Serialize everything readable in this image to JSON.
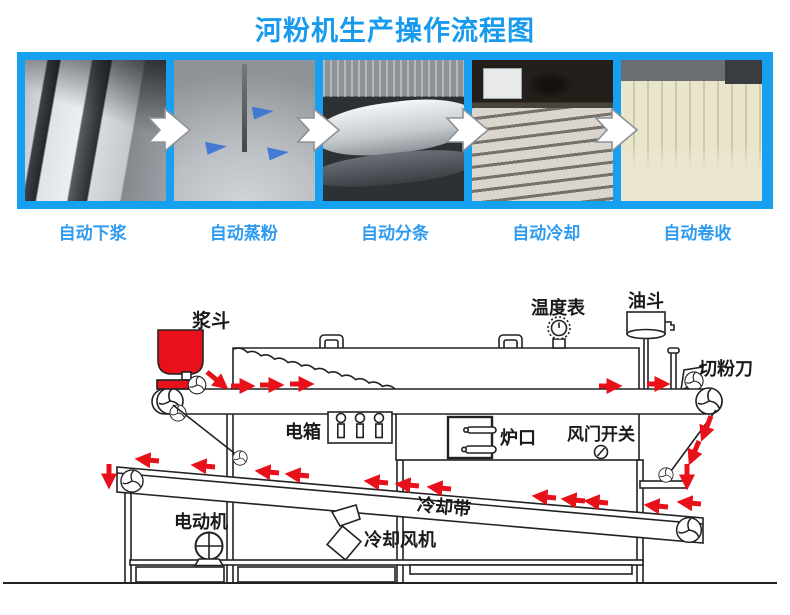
{
  "title": "河粉机生产操作流程图",
  "colors": {
    "title_blue": "#189AEE",
    "strip_blue": "#18A0F0",
    "step_label_blue": "#2E9BF0",
    "flow_arrow_red": "#E8111A",
    "hopper_red": "#E8101A",
    "line_color": "#222222"
  },
  "process_steps": [
    {
      "label": "自动下浆",
      "photo": "slurry-feeding"
    },
    {
      "label": "自动蒸粉",
      "photo": "steaming"
    },
    {
      "label": "自动分条",
      "photo": "strip-cutting"
    },
    {
      "label": "自动冷却",
      "photo": "cooling"
    },
    {
      "label": "自动卷收",
      "photo": "rolling-up"
    }
  ],
  "diagram": {
    "labels": {
      "slurry_hopper": "浆斗",
      "temperature_gauge": "温度表",
      "oil_hopper": "油斗",
      "cutting_knife": "切粉刀",
      "electric_box": "电箱",
      "furnace_opening": "炉口",
      "air_damper_switch": "风门开关",
      "cooling_belt": "冷却带",
      "cooling_fan": "冷却风机",
      "motor": "电动机"
    }
  }
}
